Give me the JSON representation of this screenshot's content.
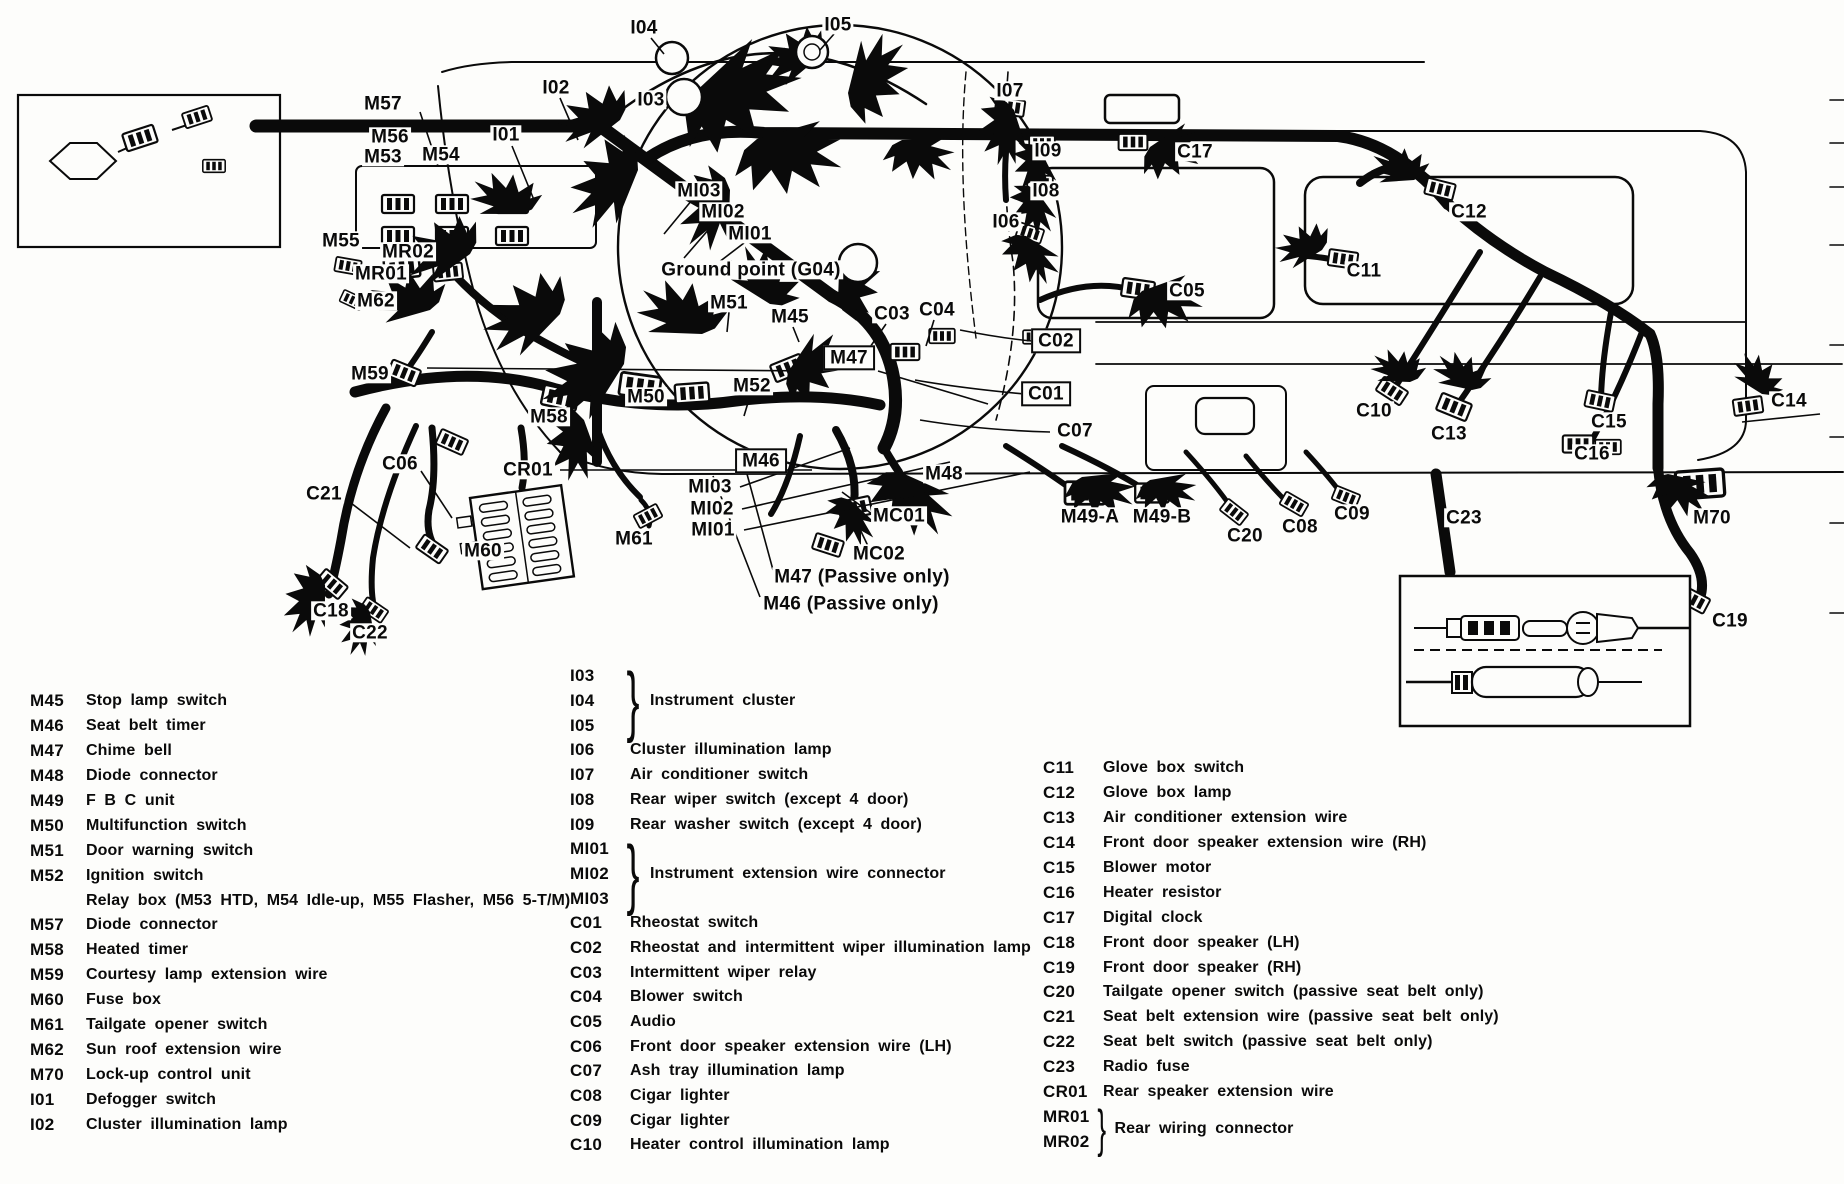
{
  "page": {
    "background": "#fdfdfb",
    "ink": "#0a0a0a",
    "type": "dashboard wiring harness diagram"
  },
  "diagram": {
    "labels": [
      {
        "text": "M57",
        "x": 383,
        "y": 104
      },
      {
        "text": "M56",
        "x": 390,
        "y": 137
      },
      {
        "text": "M53",
        "x": 383,
        "y": 157
      },
      {
        "text": "M54",
        "x": 441,
        "y": 155
      },
      {
        "text": "M55",
        "x": 341,
        "y": 241
      },
      {
        "text": "MR02",
        "x": 408,
        "y": 252
      },
      {
        "text": "MR01",
        "x": 381,
        "y": 274
      },
      {
        "text": "M62",
        "x": 376,
        "y": 301
      },
      {
        "text": "M59",
        "x": 370,
        "y": 374
      },
      {
        "text": "M58",
        "x": 549,
        "y": 417
      },
      {
        "text": "C06",
        "x": 400,
        "y": 464
      },
      {
        "text": "CR01",
        "x": 528,
        "y": 470
      },
      {
        "text": "C21",
        "x": 324,
        "y": 494
      },
      {
        "text": "M60",
        "x": 483,
        "y": 551
      },
      {
        "text": "M61",
        "x": 634,
        "y": 539
      },
      {
        "text": "C18",
        "x": 331,
        "y": 611
      },
      {
        "text": "C22",
        "x": 370,
        "y": 633
      },
      {
        "text": "I01",
        "x": 506,
        "y": 135
      },
      {
        "text": "I02",
        "x": 556,
        "y": 88
      },
      {
        "text": "I03",
        "x": 651,
        "y": 100
      },
      {
        "text": "I04",
        "x": 644,
        "y": 28
      },
      {
        "text": "I05",
        "x": 838,
        "y": 25
      },
      {
        "text": "MI03",
        "x": 699,
        "y": 191
      },
      {
        "text": "MI02",
        "x": 723,
        "y": 212
      },
      {
        "text": "MI01",
        "x": 750,
        "y": 234
      },
      {
        "text": "Ground point (G04)",
        "x": 751,
        "y": 270
      },
      {
        "text": "M51",
        "x": 729,
        "y": 303
      },
      {
        "text": "M45",
        "x": 790,
        "y": 317
      },
      {
        "text": "C03",
        "x": 892,
        "y": 314
      },
      {
        "text": "C04",
        "x": 937,
        "y": 310
      },
      {
        "text": "M47",
        "x": 849,
        "y": 358,
        "boxed": true
      },
      {
        "text": "M52",
        "x": 752,
        "y": 386
      },
      {
        "text": "M50",
        "x": 646,
        "y": 397
      },
      {
        "text": "M46",
        "x": 761,
        "y": 461,
        "boxed": true
      },
      {
        "text": "M48",
        "x": 944,
        "y": 474
      },
      {
        "text": "MI03",
        "x": 710,
        "y": 487
      },
      {
        "text": "MI02",
        "x": 712,
        "y": 509
      },
      {
        "text": "MI01",
        "x": 713,
        "y": 530
      },
      {
        "text": "MC01",
        "x": 899,
        "y": 516
      },
      {
        "text": "MC02",
        "x": 879,
        "y": 554
      },
      {
        "text": "M47 (Passive only)",
        "x": 862,
        "y": 577
      },
      {
        "text": "M46 (Passive only)",
        "x": 851,
        "y": 604
      },
      {
        "text": "M49-A",
        "x": 1090,
        "y": 517
      },
      {
        "text": "M49-B",
        "x": 1162,
        "y": 517
      },
      {
        "text": "C20",
        "x": 1245,
        "y": 536
      },
      {
        "text": "C08",
        "x": 1300,
        "y": 527
      },
      {
        "text": "C09",
        "x": 1352,
        "y": 514
      },
      {
        "text": "C23",
        "x": 1464,
        "y": 518
      },
      {
        "text": "M70",
        "x": 1712,
        "y": 518
      },
      {
        "text": "C19",
        "x": 1730,
        "y": 621
      },
      {
        "text": "I07",
        "x": 1010,
        "y": 91
      },
      {
        "text": "I09",
        "x": 1048,
        "y": 151
      },
      {
        "text": "I08",
        "x": 1046,
        "y": 191
      },
      {
        "text": "I06",
        "x": 1006,
        "y": 222
      },
      {
        "text": "C17",
        "x": 1195,
        "y": 152
      },
      {
        "text": "C05",
        "x": 1187,
        "y": 291
      },
      {
        "text": "C02",
        "x": 1056,
        "y": 341,
        "boxed": true
      },
      {
        "text": "C01",
        "x": 1046,
        "y": 394,
        "boxed": true
      },
      {
        "text": "C07",
        "x": 1075,
        "y": 431
      },
      {
        "text": "C11",
        "x": 1364,
        "y": 271
      },
      {
        "text": "C12",
        "x": 1469,
        "y": 212
      },
      {
        "text": "C10",
        "x": 1374,
        "y": 411
      },
      {
        "text": "C13",
        "x": 1449,
        "y": 434
      },
      {
        "text": "C15",
        "x": 1609,
        "y": 422
      },
      {
        "text": "C16",
        "x": 1592,
        "y": 454
      },
      {
        "text": "C14",
        "x": 1789,
        "y": 401
      }
    ]
  },
  "legend": {
    "left": {
      "x": 30,
      "y": 689,
      "row_h": 24.9,
      "code_w": 56,
      "items": [
        {
          "code": "M45",
          "desc": "Stop lamp switch"
        },
        {
          "code": "M46",
          "desc": "Seat belt timer"
        },
        {
          "code": "M47",
          "desc": "Chime bell"
        },
        {
          "code": "M48",
          "desc": "Diode connector"
        },
        {
          "code": "M49",
          "desc": "F B C unit"
        },
        {
          "code": "M50",
          "desc": "Multifunction switch"
        },
        {
          "code": "M51",
          "desc": "Door warning switch"
        },
        {
          "code": "M52",
          "desc": "Ignition switch"
        },
        {
          "code": "",
          "desc": "Relay box (M53 HTD, M54 Idle-up, M55 Flasher, M56 5-T/M)"
        },
        {
          "code": "M57",
          "desc": "Diode connector"
        },
        {
          "code": "M58",
          "desc": "Heated timer"
        },
        {
          "code": "M59",
          "desc": "Courtesy lamp extension wire"
        },
        {
          "code": "M60",
          "desc": "Fuse box"
        },
        {
          "code": "M61",
          "desc": "Tailgate opener switch"
        },
        {
          "code": "M62",
          "desc": "Sun roof extension wire"
        },
        {
          "code": "M70",
          "desc": "Lock-up control unit"
        },
        {
          "code": "I01",
          "desc": "Defogger switch"
        },
        {
          "code": "I02",
          "desc": "Cluster illumination lamp"
        }
      ]
    },
    "middle": {
      "x": 570,
      "y": 664,
      "row_h": 24.7,
      "code_w": 60,
      "items": [
        {
          "codes": [
            "I03",
            "I04",
            "I05"
          ],
          "desc": "Instrument cluster"
        },
        {
          "code": "I06",
          "desc": "Cluster illumination lamp"
        },
        {
          "code": "I07",
          "desc": "Air conditioner switch"
        },
        {
          "code": "I08",
          "desc": "Rear wiper switch (except 4 door)"
        },
        {
          "code": "I09",
          "desc": "Rear washer switch (except 4 door)"
        },
        {
          "codes": [
            "MI01",
            "MI02",
            "MI03"
          ],
          "desc": "Instrument extension wire connector"
        },
        {
          "code": "C01",
          "desc": "Rheostat switch"
        },
        {
          "code": "C02",
          "desc": "Rheostat and intermittent wiper illumination lamp"
        },
        {
          "code": "C03",
          "desc": "Intermittent wiper relay"
        },
        {
          "code": "C04",
          "desc": "Blower switch"
        },
        {
          "code": "C05",
          "desc": "Audio"
        },
        {
          "code": "C06",
          "desc": "Front door speaker extension wire (LH)"
        },
        {
          "code": "C07",
          "desc": "Ash tray illumination lamp"
        },
        {
          "code": "C08",
          "desc": "Cigar lighter"
        },
        {
          "code": "C09",
          "desc": "Cigar lighter"
        },
        {
          "code": "C10",
          "desc": "Heater control illumination lamp"
        }
      ]
    },
    "right": {
      "x": 1043,
      "y": 756,
      "row_h": 24.9,
      "code_w": 60,
      "items": [
        {
          "code": "C11",
          "desc": "Glove box switch"
        },
        {
          "code": "C12",
          "desc": "Glove box lamp"
        },
        {
          "code": "C13",
          "desc": "Air conditioner extension wire"
        },
        {
          "code": "C14",
          "desc": "Front door speaker extension wire (RH)"
        },
        {
          "code": "C15",
          "desc": "Blower motor"
        },
        {
          "code": "C16",
          "desc": "Heater resistor"
        },
        {
          "code": "C17",
          "desc": "Digital clock"
        },
        {
          "code": "C18",
          "desc": "Front door speaker (LH)"
        },
        {
          "code": "C19",
          "desc": "Front door speaker (RH)"
        },
        {
          "code": "C20",
          "desc": "Tailgate opener switch (passive seat belt only)"
        },
        {
          "code": "C21",
          "desc": "Seat belt extension wire (passive seat belt only)"
        },
        {
          "code": "C22",
          "desc": "Seat belt switch (passive seat belt only)"
        },
        {
          "code": "C23",
          "desc": "Radio fuse"
        },
        {
          "code": "CR01",
          "desc": "Rear speaker extension wire"
        },
        {
          "codes": [
            "MR01",
            "MR02"
          ],
          "desc": "Rear wiring connector"
        }
      ]
    }
  }
}
